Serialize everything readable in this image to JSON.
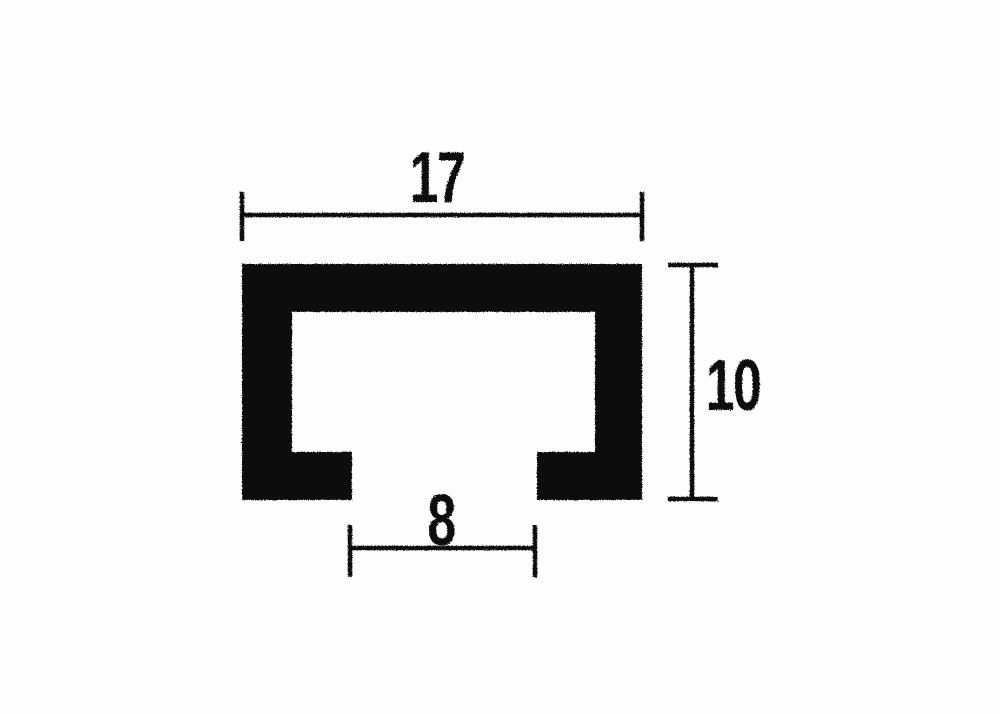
{
  "page": {
    "background_color": "#fdfdfc",
    "ink_color": "#0f0f0f"
  },
  "diagram": {
    "kind": "technical-drawing",
    "subject": "C-channel profile cross-section, black filled, with dimension lines",
    "dimensions": {
      "width": {
        "label": "17",
        "value": 17,
        "placement": "top, horizontal, spans full profile width"
      },
      "height": {
        "label": "10",
        "value": 10,
        "placement": "right, vertical, spans full profile height"
      },
      "opening": {
        "label": "8",
        "value": 8,
        "placement": "bottom, horizontal, spans slot opening width"
      }
    }
  }
}
